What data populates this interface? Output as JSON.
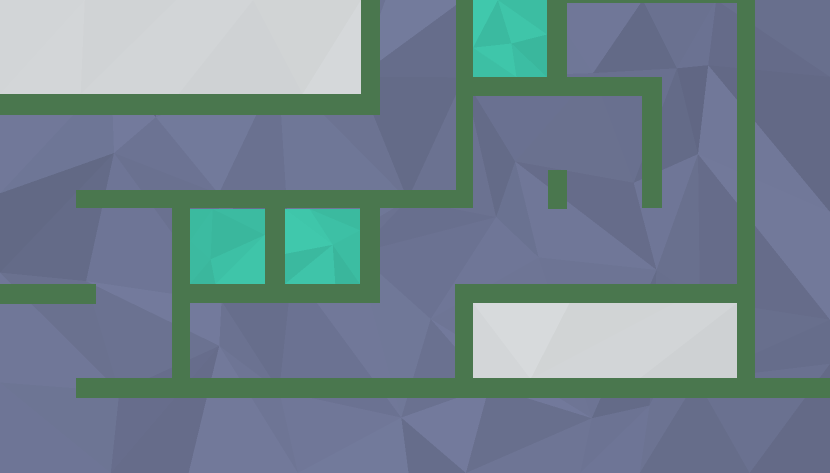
{
  "scene": {
    "width": 830,
    "height": 473,
    "colors": {
      "background": "#6a7190",
      "wall": "#4a774e",
      "tile": "#3dbfa4",
      "zone": "#d4d7d9"
    },
    "walls": [
      {
        "x": 0,
        "y": 94,
        "w": 380,
        "h": 21
      },
      {
        "x": 361,
        "y": 0,
        "w": 19,
        "h": 115
      },
      {
        "x": 76,
        "y": 190,
        "w": 397,
        "h": 18
      },
      {
        "x": 456,
        "y": 0,
        "w": 17,
        "h": 208
      },
      {
        "x": 547,
        "y": 0,
        "w": 20,
        "h": 96
      },
      {
        "x": 457,
        "y": 77,
        "w": 205,
        "h": 19
      },
      {
        "x": 642,
        "y": 77,
        "w": 20,
        "h": 131
      },
      {
        "x": 565,
        "y": 0,
        "w": 172,
        "h": 3
      },
      {
        "x": 548,
        "y": 170,
        "w": 19,
        "h": 39
      },
      {
        "x": 737,
        "y": 0,
        "w": 18,
        "h": 398
      },
      {
        "x": 172,
        "y": 208,
        "w": 18,
        "h": 190
      },
      {
        "x": 265,
        "y": 208,
        "w": 20,
        "h": 76
      },
      {
        "x": 360,
        "y": 207,
        "w": 20,
        "h": 96
      },
      {
        "x": 190,
        "y": 284,
        "w": 190,
        "h": 19
      },
      {
        "x": 0,
        "y": 284,
        "w": 96,
        "h": 20
      },
      {
        "x": 76,
        "y": 378,
        "w": 754,
        "h": 20
      },
      {
        "x": 455,
        "y": 284,
        "w": 282,
        "h": 19
      },
      {
        "x": 455,
        "y": 284,
        "w": 18,
        "h": 95
      }
    ],
    "tiles": [
      {
        "x": 473,
        "y": 0,
        "w": 74,
        "h": 77
      },
      {
        "x": 190,
        "y": 209,
        "w": 75,
        "h": 75
      },
      {
        "x": 285,
        "y": 209,
        "w": 75,
        "h": 75
      }
    ],
    "zones": [
      {
        "x": 0,
        "y": 0,
        "w": 361,
        "h": 94
      },
      {
        "x": 473,
        "y": 303,
        "w": 264,
        "h": 76
      }
    ]
  }
}
